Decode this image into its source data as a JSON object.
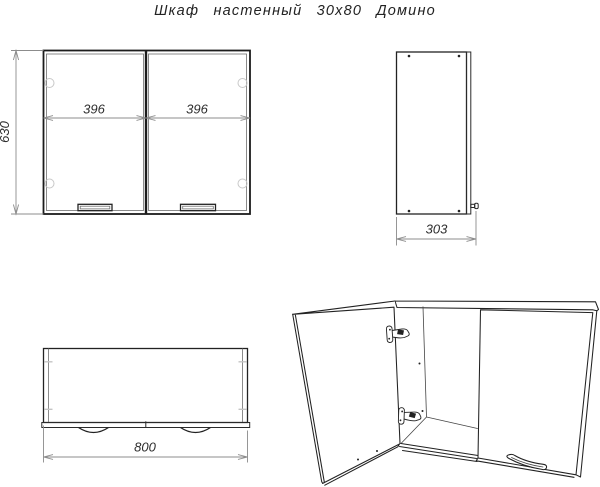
{
  "drawing": {
    "title": "Шкаф настенный 30х80 Домино",
    "dimensions": {
      "height": "630",
      "door_width_left": "396",
      "door_width_right": "396",
      "depth": "303",
      "width": "800"
    },
    "colors": {
      "background": "#ffffff",
      "outline": "#1c1c1c",
      "dimension_lines": "#8c8c8c",
      "text": "#2e2e2e"
    }
  }
}
